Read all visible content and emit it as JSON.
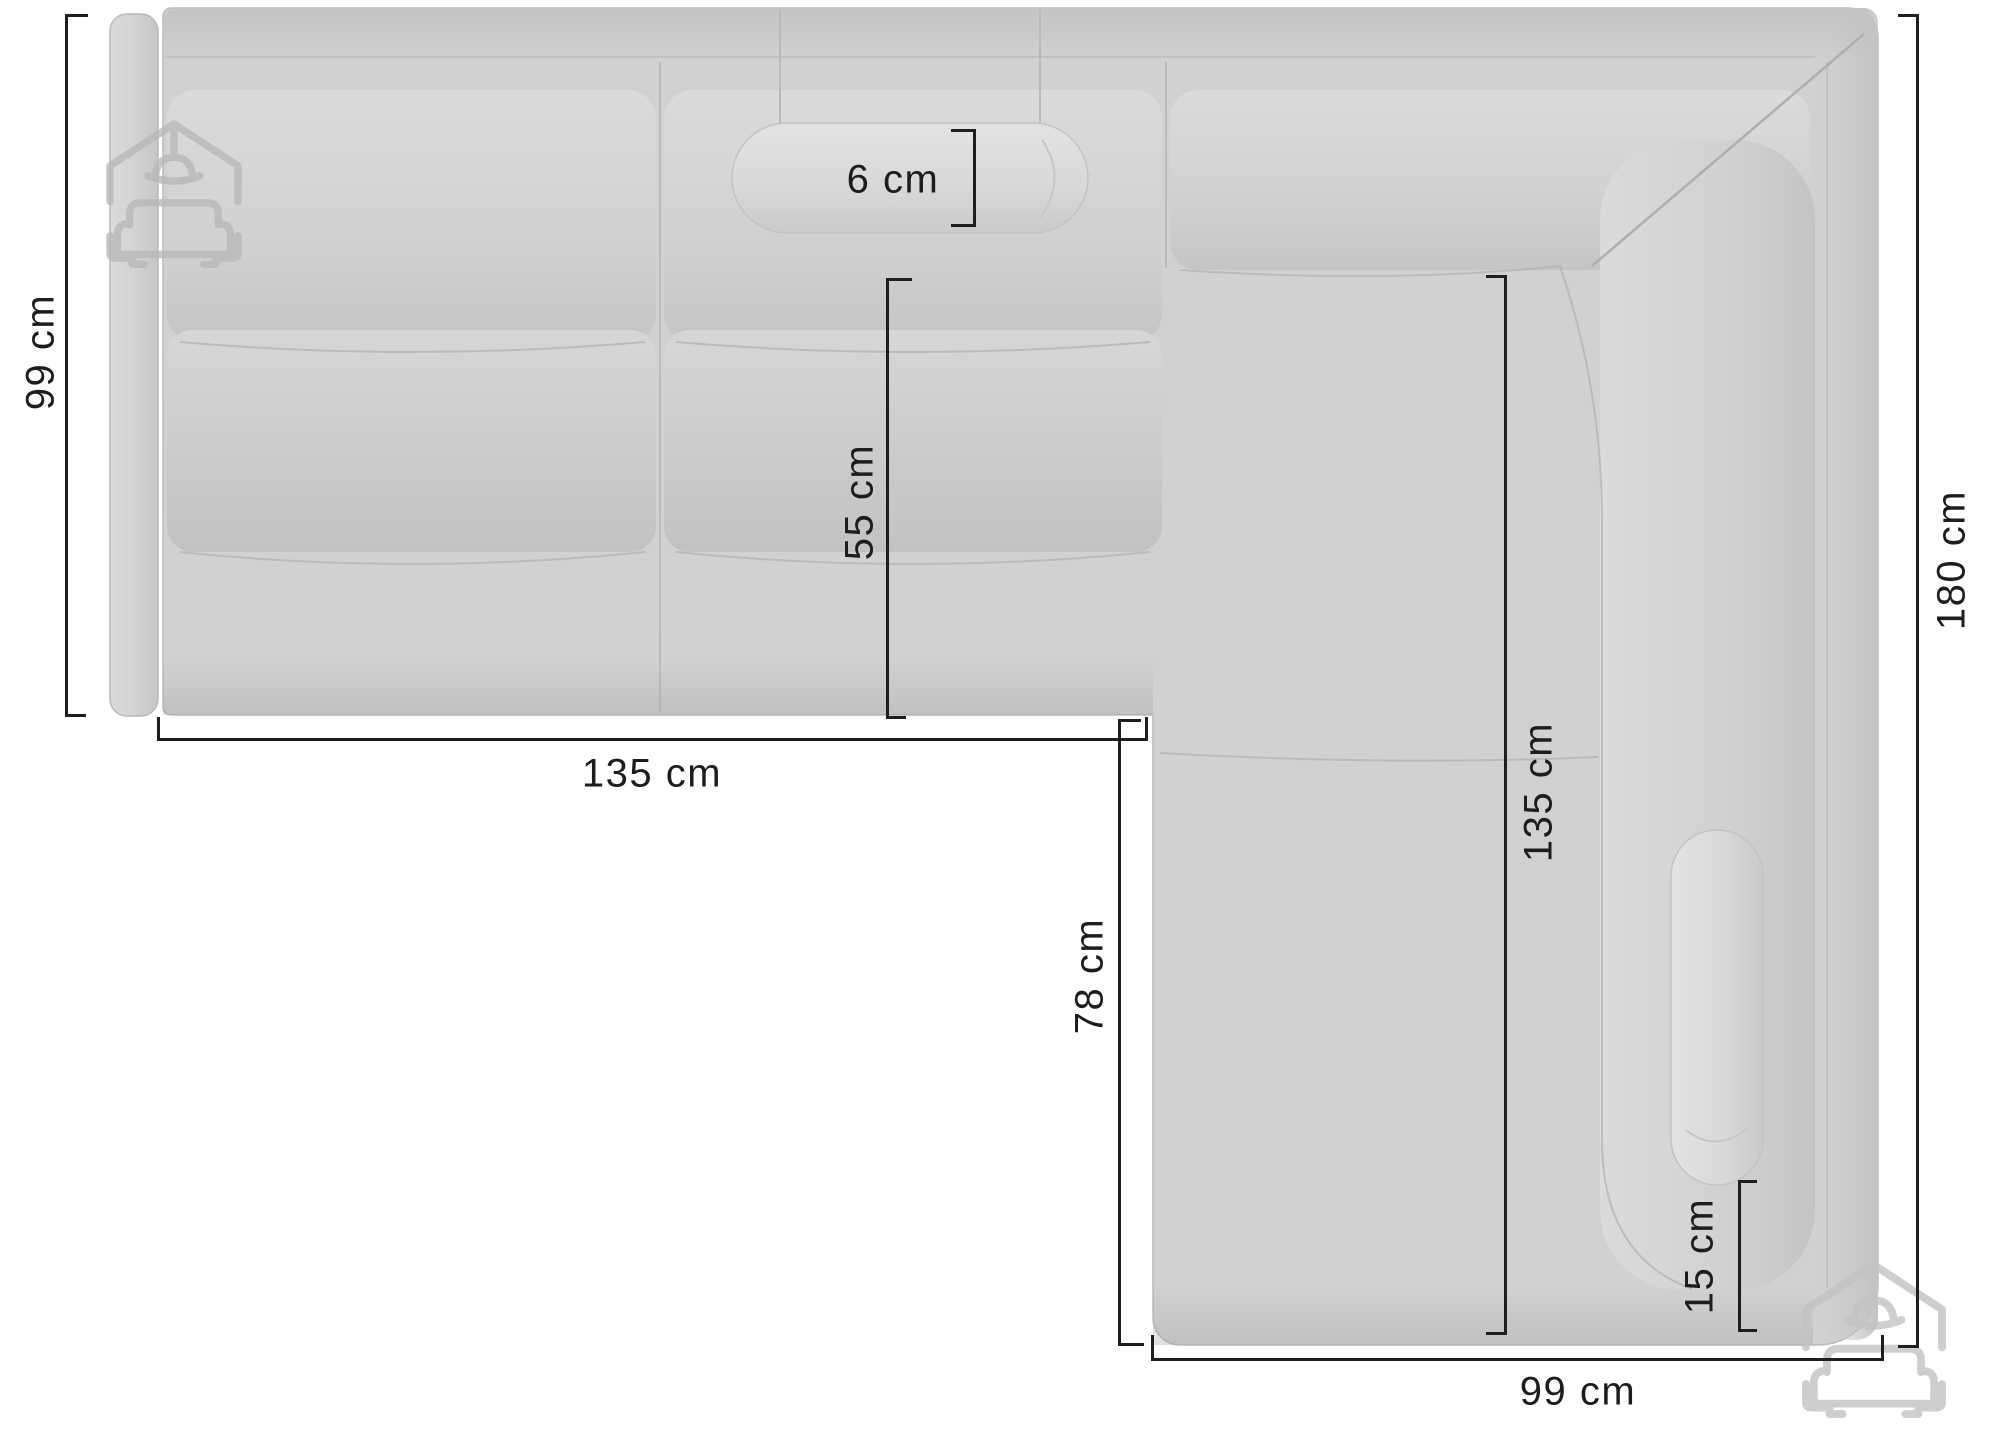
{
  "diagram": {
    "type": "furniture-dimension-diagram",
    "subject": "corner sofa, top view",
    "unit": "cm",
    "background_color": "#ffffff",
    "dimension_line_color": "#1e1e1e",
    "sofa_fill_color": "#d0d1d2",
    "watermark_color": "#c2c3c4",
    "watermark_icon": "house-with-sofa-logo"
  },
  "dimensions": [
    {
      "id": "back-depth-left",
      "label": "99 cm",
      "value": 99,
      "unit": "cm",
      "orientation": "vertical",
      "side": "left"
    },
    {
      "id": "left-section-width",
      "label": "135 cm",
      "value": 135,
      "unit": "cm",
      "orientation": "horizontal",
      "side": "bottom-left"
    },
    {
      "id": "headrest-thickness",
      "label": "6 cm",
      "value": 6,
      "unit": "cm",
      "orientation": "bracket",
      "side": "top-middle"
    },
    {
      "id": "seat-depth",
      "label": "55 cm",
      "value": 55,
      "unit": "cm",
      "orientation": "vertical",
      "side": "middle"
    },
    {
      "id": "chaise-inner-length",
      "label": "135 cm",
      "value": 135,
      "unit": "cm",
      "orientation": "vertical",
      "side": "inner-right"
    },
    {
      "id": "total-length-right",
      "label": "180 cm",
      "value": 180,
      "unit": "cm",
      "orientation": "vertical",
      "side": "right"
    },
    {
      "id": "chaise-left-length",
      "label": "78 cm",
      "value": 78,
      "unit": "cm",
      "orientation": "vertical",
      "side": "inner-left"
    },
    {
      "id": "pillow-offset",
      "label": "15 cm",
      "value": 15,
      "unit": "cm",
      "orientation": "bracket",
      "side": "chaise-right"
    },
    {
      "id": "chaise-width",
      "label": "99 cm",
      "value": 99,
      "unit": "cm",
      "orientation": "horizontal",
      "side": "bottom-right"
    }
  ]
}
